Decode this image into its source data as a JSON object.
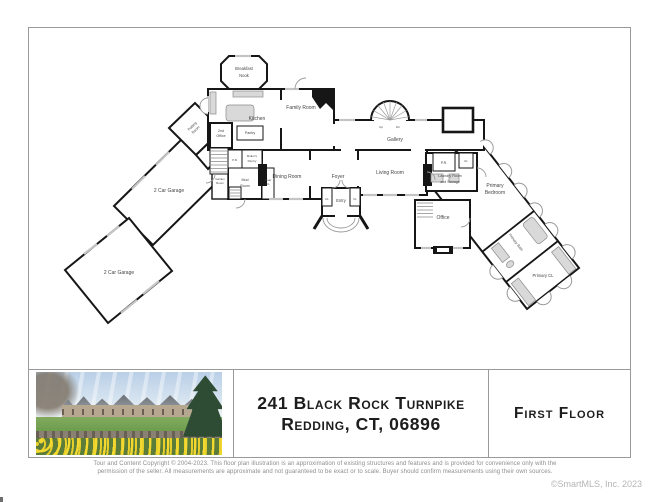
{
  "plan": {
    "colors": {
      "wall": "#161616",
      "fixture": "#d6d6d6",
      "window": "#c2c2c2",
      "door_swing": "#999999",
      "label": "#454545"
    },
    "labels": {
      "breakfast_nook": [
        "Breakfast",
        "Nook"
      ],
      "kitchen": "Kitchen",
      "family_room": "Family Room",
      "gallery": "Gallery",
      "stair_up": "Up",
      "stair_dn": "Dn",
      "pantry": "Pantry",
      "second_office": [
        "2nd",
        "Office"
      ],
      "pr_kitchen": "P.R.",
      "butlers_pantry": [
        "Butler's",
        "Pantry"
      ],
      "mud_room": [
        "Mud",
        "Room"
      ],
      "coat_cl": [
        "Coat",
        "CL"
      ],
      "garden_room": [
        "Garden",
        "Room"
      ],
      "potting_room": [
        "Potting",
        "Room"
      ],
      "garage_upper": "2 Car Garage",
      "garage_lower": "2 Car Garage",
      "dining_room": "Dining Room",
      "foyer": "Foyer",
      "living_room": "Living Room",
      "entry": "Entry",
      "cl_entry_left": "CL",
      "cl_entry_right": "CL",
      "laundry": [
        "Laundry Room",
        "and Storage"
      ],
      "pr_hall": "P.R.",
      "cl_hall": "CL",
      "office": "Office",
      "primary_bedroom": [
        "Primary",
        "Bedroom"
      ],
      "primary_bath": "Primary Bath",
      "primary_cl": "Primary CL"
    }
  },
  "footer": {
    "address_line1": "241 Black Rock Turnpike",
    "address_line2": "Redding, CT, 06896",
    "floor_label": "First Floor"
  },
  "photo": {
    "alt": "stone estate exterior with lawn, stone wall and daffodil field"
  },
  "disclaimer": "Tour and Content Copyright © 2004-2023. This floor plan illustration is an approximation of existing structures and features and is provided for convenience only with the permission of the seller. All measurements are approximate and not guaranteed to be exact or to scale. Buyer should confirm measurements using their own sources.",
  "credit": "©SmartMLS, Inc.  2023"
}
